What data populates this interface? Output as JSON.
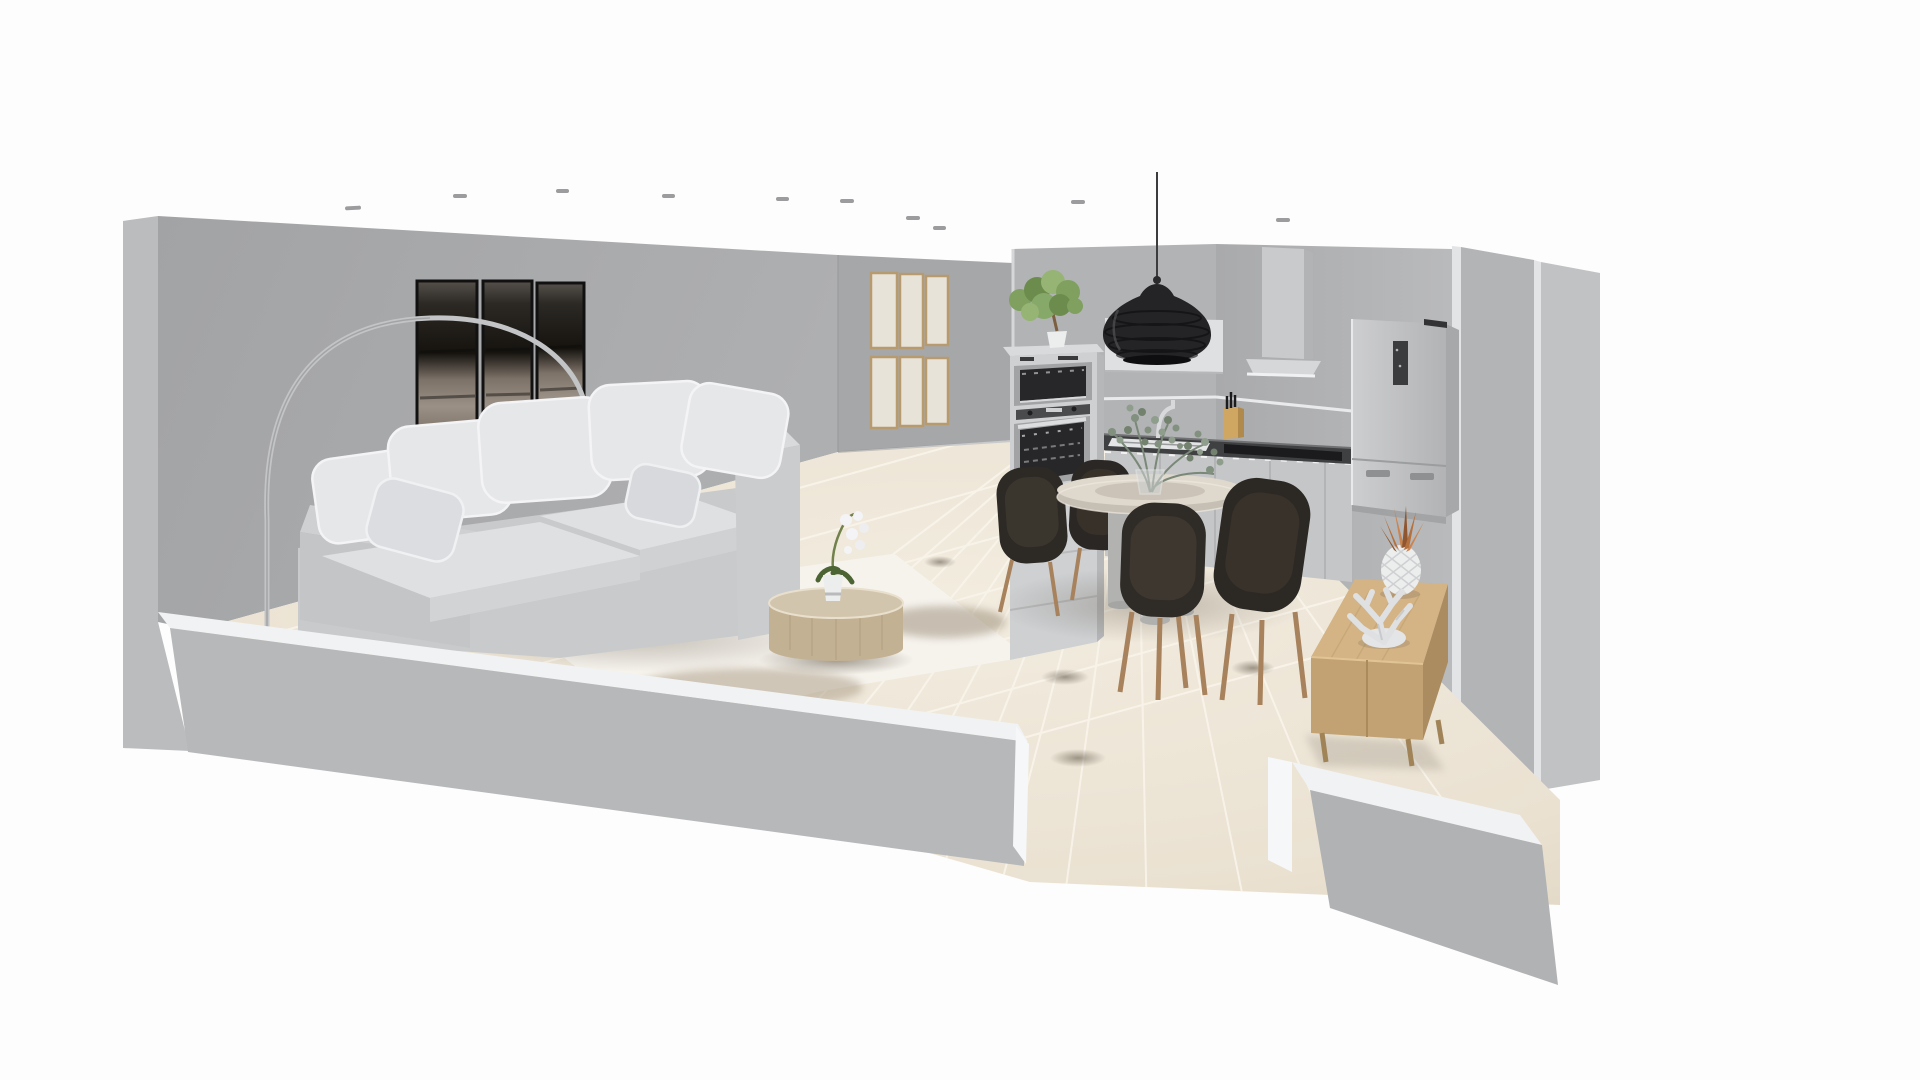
{
  "meta": {
    "description": "3D dollhouse view of an open-plan living room with kitchen and dining area, cut-away front walls, white background",
    "view_label": "3d-room-view"
  },
  "scene": {
    "areas": [
      "living-room",
      "kitchen",
      "dining-area"
    ],
    "objects": [
      "ceiling-spotlights",
      "left-wall",
      "back-wall",
      "right-wall",
      "front-parapet-walls",
      "tiled-floor",
      "area-rug",
      "sectional-sofa",
      "sofa-pillows",
      "arc-floor-lamp",
      "triptych-wall-art",
      "gallery-frame-grid",
      "yucca-plant",
      "round-coffee-table",
      "orchid-in-pot",
      "dining-table",
      "dining-chairs",
      "eucalyptus-vase",
      "pendant-lamp",
      "kitchen-wall-cabinet",
      "range-hood",
      "oven-column",
      "microwave",
      "wall-oven",
      "potted-tree",
      "kitchen-counter",
      "sink",
      "faucet",
      "knife-block",
      "cooktop",
      "refrigerator",
      "sideboard",
      "pineapple-ornament",
      "coral-ornament"
    ]
  },
  "colors": {
    "bg": "#fdfdfd",
    "ceilingLight": "#9c9c9e",
    "wallLeft": "#a8a9ab",
    "wallLeftOuter": "#bbbcbe",
    "wallBackLiving": "#a6a7a9",
    "wallBackKitchen": "#b2b3b5",
    "wallRight": "#aeafb1",
    "wallRightB": "#b3b4b6",
    "wallRightC": "#c1c2c4",
    "wallEdgeHighlight": "#e3e4e6",
    "parapetTop": "#f1f2f3",
    "parapetFaceLeft": "#b7b8ba",
    "parapetFaceRight": "#b1b2b4",
    "parapetEnd": "#f6f7f8",
    "floor": "#ece4d4",
    "grout": "#faf5ec",
    "floorShadow": "#6b6257",
    "rug": "#f6f3ed",
    "rugShade": "#a99a83",
    "artFrame": "#111111",
    "frameWood": "#b79b6f",
    "frameCanvas": "#e7e3d9",
    "lampMetal": "#c3c4c6",
    "lampGlobe": "#d7d9dc",
    "sofaBase": "#c9cacc",
    "sofaCushion": "#dfe0e2",
    "sofaPillow": "#e6e7e9",
    "sofaPiping": "#f4f4f6",
    "sofaShade": "#cfd0d2",
    "plantGreen": "#7fa05e",
    "plantGreenDark": "#5f7f49",
    "plantGreenLight": "#96b473",
    "trunk": "#7b5f40",
    "coffeeTop": "#d2c5ae",
    "coffeeSide": "#c3b193",
    "potWhite": "#eceded",
    "orchidFlower": "#f4f4f6",
    "orchidStem": "#72814b",
    "tableTop": "#dfd8cd",
    "tableUnder": "#c6bfb4",
    "pedestal": "#bdbebc",
    "chairShell": "#2d2925",
    "chairInner": "#3e382f",
    "chairLeg": "#a7825c",
    "vase": "#d2d6d6",
    "eucalyptus": "#81907f",
    "pendant": "#242426",
    "cabinet": "#ced0d2",
    "cabinetSide": "#b6b7b9",
    "cabinetTop": "#d9dadc",
    "wallCabinet": "#dfe0e2",
    "hood": "#c9cacc",
    "counter": "#3f4042",
    "baseCabinet": "#c5c6c8",
    "sink": "#f2f3f5",
    "steel": "#a2a3a5",
    "glassDark": "#27272a",
    "knifeWood": "#cfa763",
    "cooktop": "#1b1b1d",
    "fridge": "#c4c5c7",
    "fridgeSide": "#a7a8aa",
    "fridgePanel": "#3b3c3e",
    "sideboardTop": "#d4b385",
    "sideboardFront": "#c2a272",
    "sideboardSide": "#ab8c60",
    "sideboardLeg": "#a08357",
    "pineapple": "#eceded",
    "pineappleLeaf": "#b4713d",
    "coral": "#dfe0e2"
  }
}
